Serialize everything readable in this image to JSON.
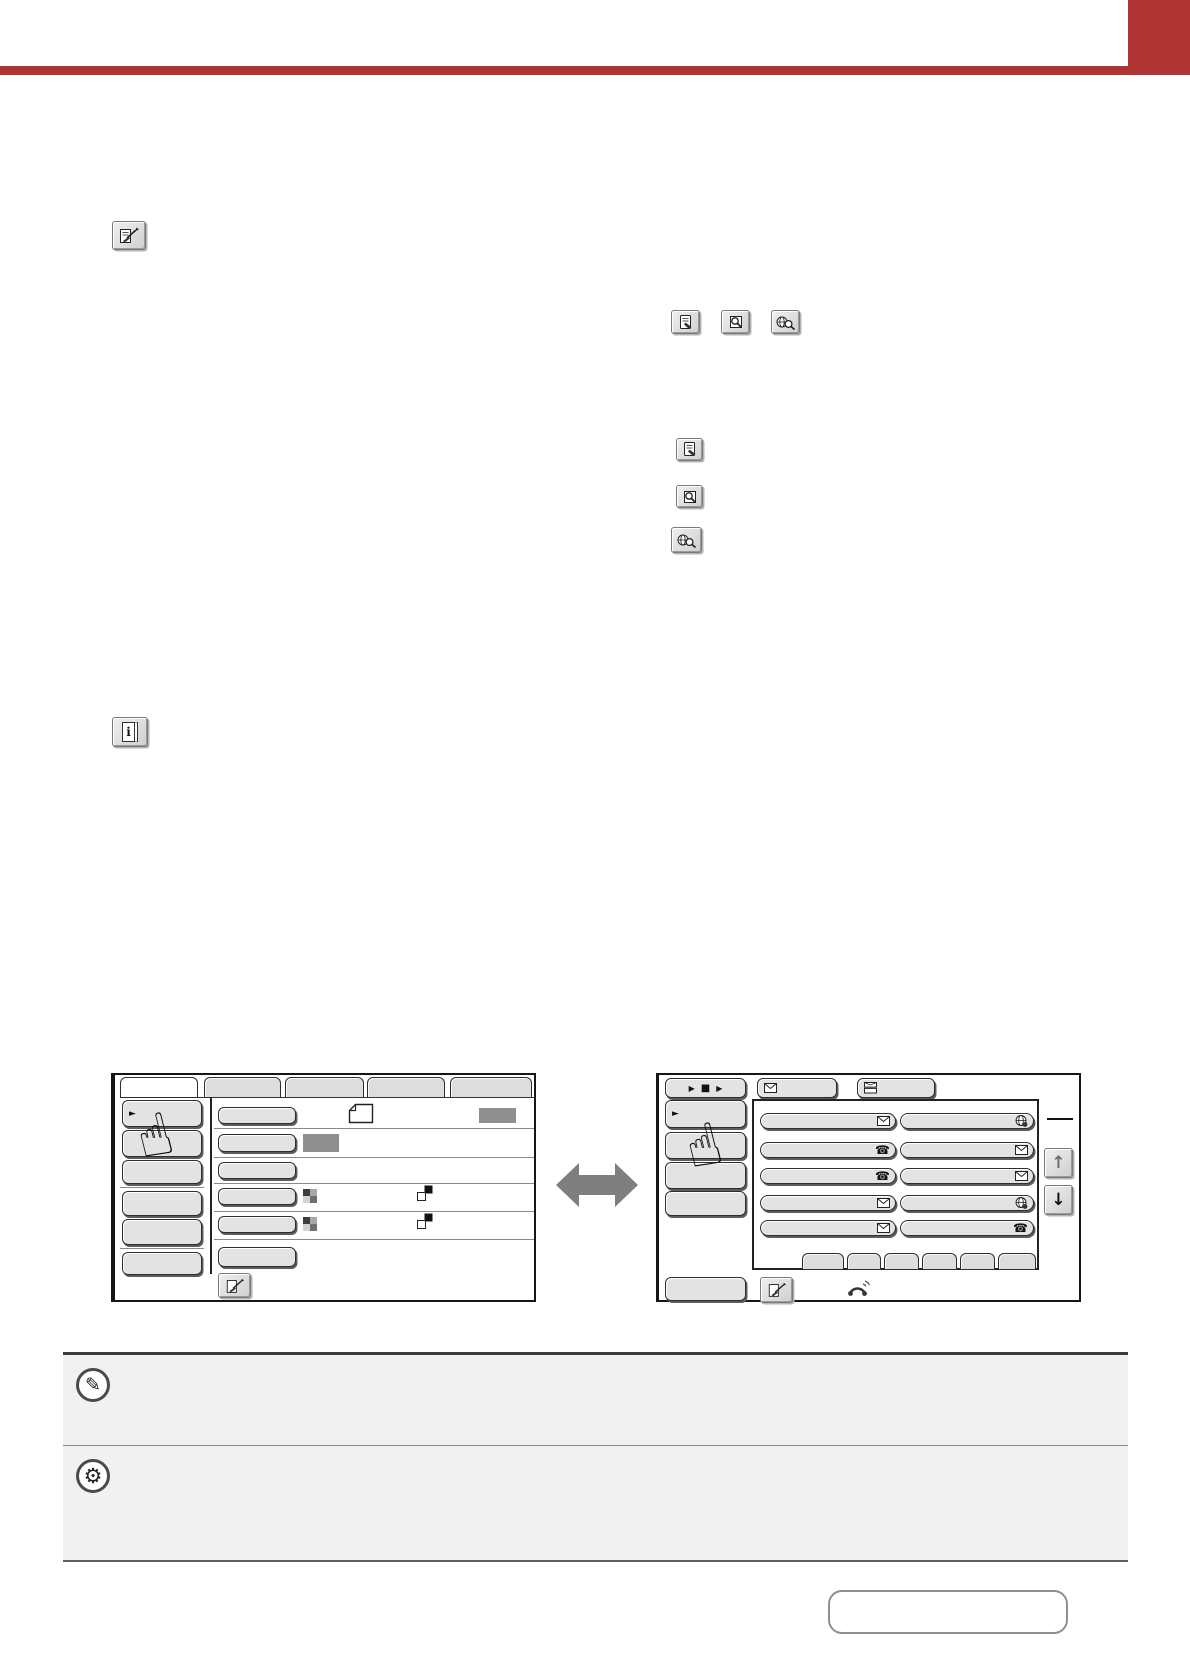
{
  "colors": {
    "accent-red": "#b13434",
    "arrow-gray": "#7f7f7f",
    "frame": "#161616",
    "btn-face": "#e3e3e3",
    "tool-face": "#d9d9d9",
    "note-bg": "#f1f1f1",
    "gray-box": "#8f8f8f"
  },
  "glyphs": {
    "pointing_hand": "☝",
    "play": "▶",
    "stop": "■",
    "menu_arrow": "►",
    "up_arrow": "↑",
    "down_arrow": "↓",
    "phone": "☎",
    "pencil": "✎",
    "gear": "⚙",
    "info_letter": "i"
  },
  "icons": {
    "address_review_key": "document-with-pen-and-ne-arrow",
    "document_edit_key": "document-with-pen",
    "address_search_key": "magnifier-over-document",
    "global_address_search_key": "magnifier-with-globe",
    "information_key": "book-with-letter-i",
    "email": "envelope",
    "stacked_mail": "two-stacked-envelopes",
    "internet_fax": "globe-with-dot",
    "fax": "telephone-handset",
    "speaker": "handset-with-sound-waves",
    "original_paper": "dog-eared-page-outline",
    "color_mode": "2x2-checker",
    "exposure": "overlapping-black-white-squares",
    "note": "pencil-in-circle",
    "system_settings": "gear-in-circle"
  },
  "left_screen": {
    "description": "condition-settings-screen-mockup",
    "tab_count": 5,
    "selected_tab_index": 0,
    "left_menu_button_count": 6,
    "rows": [
      {
        "key": true,
        "icons": [
          "original_paper"
        ],
        "gray_value_box_right": true
      },
      {
        "key": true,
        "gray_value_box_inline": true
      },
      {
        "key": true
      },
      {
        "key": true,
        "icons": [
          "color_mode",
          "exposure"
        ]
      },
      {
        "key": true,
        "icons": [
          "color_mode",
          "exposure"
        ]
      },
      {
        "key": true
      }
    ],
    "bottom_key": "address_review_key"
  },
  "right_screen": {
    "description": "address-book-screen-mockup",
    "resend_key_glyphs": [
      "play",
      "stop",
      "play"
    ],
    "top_tabs": [
      "email",
      "stacked_mail"
    ],
    "left_menu_button_count": 5,
    "address_rows": [
      {
        "left_icon": "email",
        "right_icon": "internet_fax"
      },
      {
        "left_icon": "fax",
        "right_icon": "email"
      },
      {
        "left_icon": "fax",
        "right_icon": "email"
      },
      {
        "left_icon": "email",
        "right_icon": "internet_fax"
      },
      {
        "left_icon": "email",
        "right_icon": "fax"
      }
    ],
    "index_tab_count": 6,
    "scroll_keys": [
      "up_arrow",
      "down_arrow"
    ],
    "bottom_keys": [
      "address_review_key",
      "speaker"
    ]
  },
  "notes": [
    {
      "icon": "note"
    },
    {
      "icon": "system_settings"
    }
  ],
  "contents_link": {
    "label": ""
  }
}
